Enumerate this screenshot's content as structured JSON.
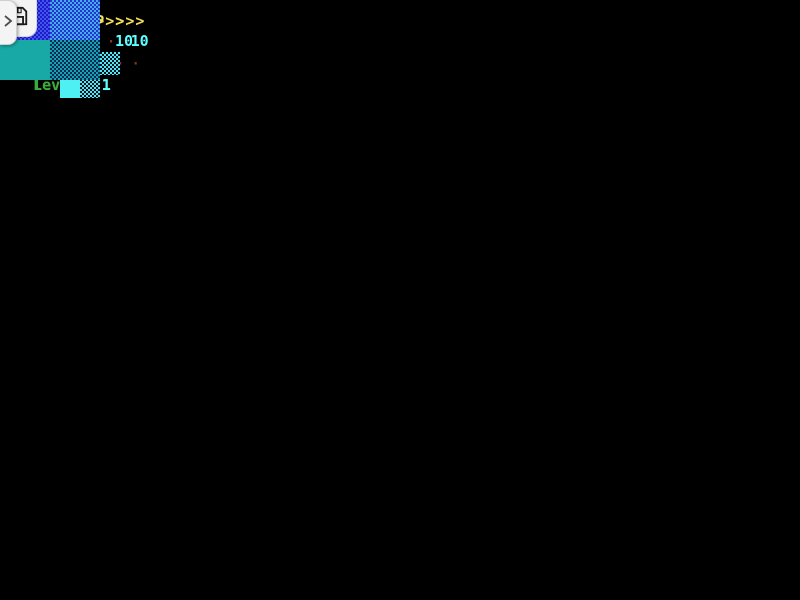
{
  "toolbar": {
    "save_icon": "floppy-disk"
  },
  "side_tab": {
    "chevron_icon": "chevron-right"
  },
  "champ_panel": {
    "title": "<<< CHAMP >>>",
    "rows": [
      {
        "label": "score",
        "dots": "· · · · ·",
        "value": "10"
      },
      {
        "label": " lines",
        "dots": "· · · · ·",
        "value": ""
      },
      {
        "label": "  level",
        "dots": "· ·",
        "value": "1"
      }
    ]
  },
  "you_panel": {
    "title": "<<< YOU >>>",
    "rows": [
      {
        "label": "score",
        "dots": "· · · ·",
        "value": "10"
      },
      {
        "label": " lines",
        "dots": "· · · ·",
        "value": ""
      },
      {
        "label": "  Level",
        "dots": "· ·",
        "value": "1"
      }
    ]
  },
  "next_panel": {
    "prefix": ">>>",
    "title": "See",
    "suffix": "<<<"
  },
  "colors": {
    "panel_red": "#a40808",
    "accent_yellow": "#f2de58",
    "text_green": "#3bab3b",
    "value_cyan": "#5cffff",
    "dots_maroon": "#8a3a28",
    "pattern_cyan": "#7be7fa",
    "pattern_navy": "#1e2ca6",
    "piece_blue": "#1c1cc8",
    "piece_teal": "#18a9a6",
    "preview_cyan": "#4ff0f4"
  }
}
